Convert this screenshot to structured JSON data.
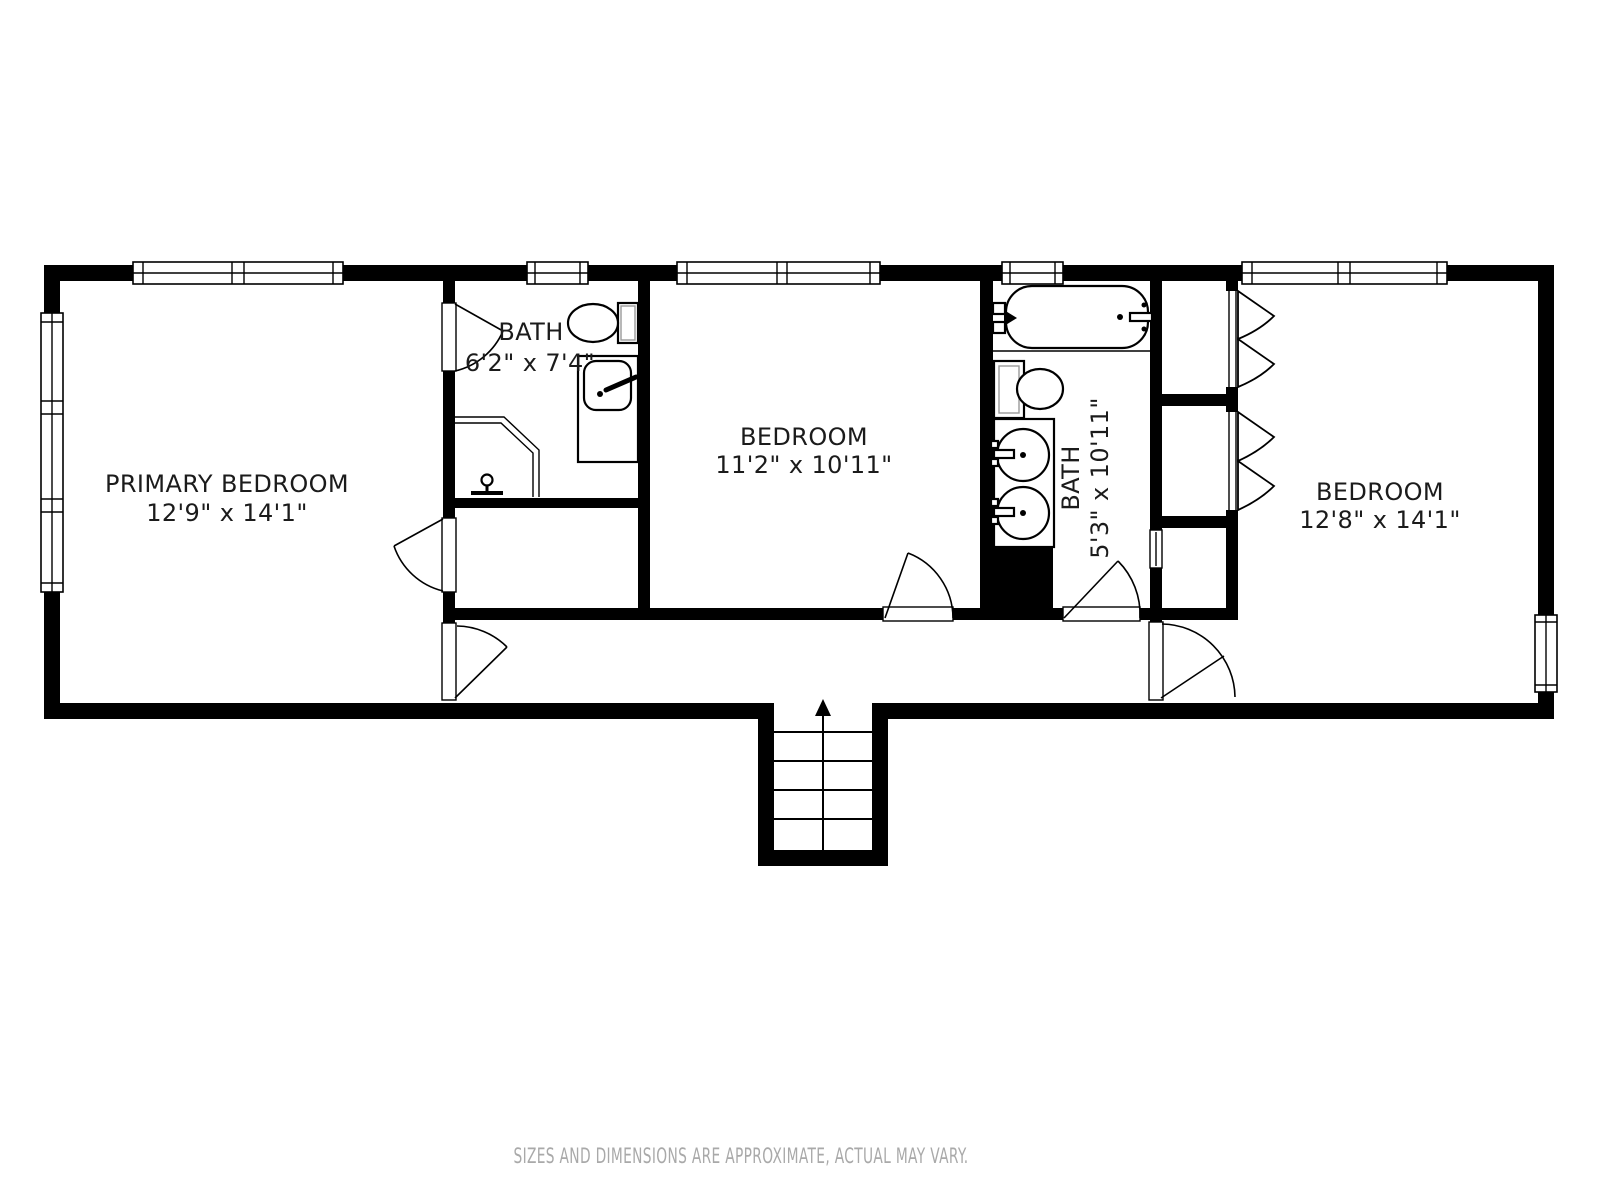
{
  "floorplan": {
    "rooms": [
      {
        "id": "primary-bedroom",
        "name": "PRIMARY BEDROOM",
        "dimensions": "12'9\" x 14'1\""
      },
      {
        "id": "bath-1",
        "name": "BATH",
        "dimensions": "6'2\" x 7'4\""
      },
      {
        "id": "bedroom-2",
        "name": "BEDROOM",
        "dimensions": "11'2\" x 10'11\""
      },
      {
        "id": "bath-2",
        "name": "BATH",
        "dimensions": "5'3\" x 10'11\""
      },
      {
        "id": "bedroom-3",
        "name": "BEDROOM",
        "dimensions": "12'8\" x 14'1\""
      }
    ],
    "stairs": {
      "direction": "up"
    },
    "disclaimer": "SIZES AND DIMENSIONS ARE APPROXIMATE, ACTUAL MAY VARY.",
    "colors": {
      "wall": "#000000",
      "background": "#ffffff",
      "label": "#1b1b1b",
      "disclaimer": "#a9a9a9"
    }
  }
}
